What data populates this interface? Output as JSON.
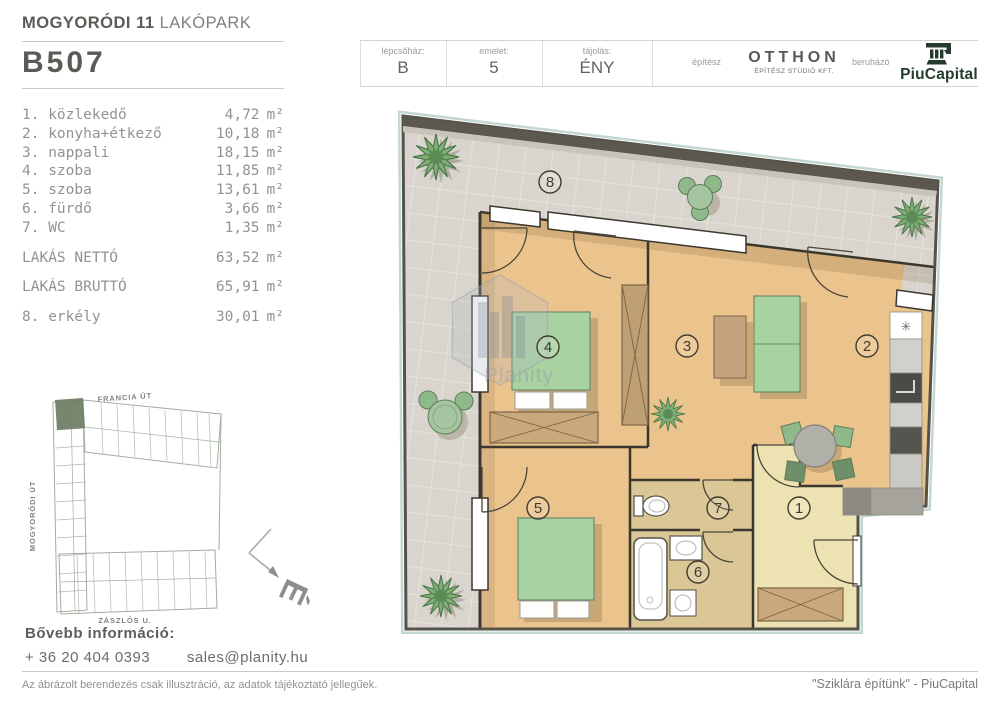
{
  "project": {
    "name_bold": "MOGYORÓDI 11",
    "name_light": "LAKÓPARK",
    "unit_id": "B507"
  },
  "info_bar": {
    "staircase_label": "lépcsőház:",
    "staircase_value": "B",
    "floor_label": "emelet:",
    "floor_value": "5",
    "orientation_label": "tájolás:",
    "orientation_value": "ÉNY",
    "architect_label": "építész",
    "architect_name": "OTTHON",
    "architect_subtitle": "ÉPÍTÉSZ STÚDIÓ KFT.",
    "developer_label": "beruházó",
    "developer_name": "PiuCapital"
  },
  "room_list": {
    "unit": "m²",
    "rooms": [
      {
        "label": "1. közlekedő",
        "area": "4,72"
      },
      {
        "label": "2. konyha+étkező",
        "area": "10,18"
      },
      {
        "label": "3. nappali",
        "area": "18,15"
      },
      {
        "label": "4. szoba",
        "area": "11,85"
      },
      {
        "label": "5. szoba",
        "area": "13,61"
      },
      {
        "label": "6. fürdő",
        "area": "3,66"
      },
      {
        "label": "7. WC",
        "area": "1,35"
      }
    ],
    "totals": [
      {
        "label": "LAKÁS NETTÓ",
        "area": "63,52"
      },
      {
        "label": "LAKÁS BRUTTÓ",
        "area": "65,91"
      }
    ],
    "balcony": {
      "label": "8. erkély",
      "area": "30,01"
    }
  },
  "site_map": {
    "street_top": "FRANCIA ÚT",
    "street_left": "MOGYORÓDI ÚT",
    "street_bottom": "ZÁSZLÓS U.",
    "compass_letter": "É"
  },
  "contact": {
    "heading": "Bővebb információ:",
    "phone": "+ 36 20 404 0393",
    "email": "sales@planity.hu"
  },
  "footer": {
    "disclaimer": "Az ábrázolt berendezés csak illusztráció, az adatok tájékoztató jellegűek.",
    "slogan": "\"Sziklára építünk\" - PiuCapital"
  },
  "floor_plan": {
    "watermark": "Planity",
    "sink_symbol": "✳",
    "labels": [
      "1",
      "2",
      "3",
      "4",
      "5",
      "6",
      "7",
      "8"
    ]
  },
  "colors": {
    "accent_dark_green": "#243c2c",
    "text_primary": "#575c55",
    "text_muted": "#8f958d",
    "plan_wood": "#ebc48d",
    "plan_tile": "#d9d5ce",
    "plan_green": "#a9d2a1",
    "hall_beige": "#ece2b2",
    "map_highlight": "#6d7c64"
  }
}
